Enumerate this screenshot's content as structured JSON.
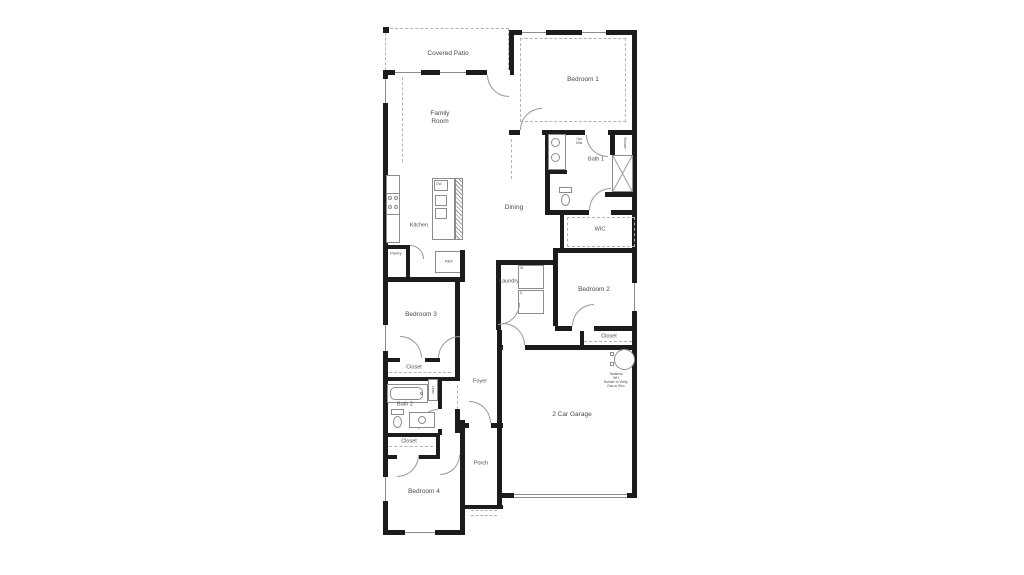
{
  "plan": {
    "labels": {
      "covered_patio": "Covered Patio",
      "bedroom1": "Bedroom 1",
      "family_room": "Family Room",
      "bath1": "Bath 1",
      "opt_sink": "Opt Sink",
      "shower": "Shower",
      "wic": "WIC",
      "dining": "Dining",
      "kitchen": "Kitchen",
      "pantry": "Pantry",
      "laundry": "Laundry",
      "bedroom2": "Bedroom 2",
      "closet_bedroom2": "Closet",
      "bedroom3": "Bedroom 3",
      "closet_bedroom3": "Closet",
      "foyer": "Foyer",
      "bath2": "Bath 2",
      "linen": "Linen",
      "closet_bedroom4": "Closet",
      "bedroom4": "Bedroom 4",
      "garage": "2 Car Garage",
      "porch": "Porch"
    },
    "appliances": {
      "dishwasher": "DW",
      "refrigerator": "REF",
      "washer": "W",
      "dryer": "D"
    },
    "water_heater_note": [
      "Tankless",
      "WH",
      "Builder to Verify",
      "Gas or Elec"
    ],
    "colors": {
      "wall": "#1c1c1c",
      "fixture_line": "#8c8c8c",
      "label_text": "#4a4a4a",
      "background": "#ffffff"
    }
  }
}
